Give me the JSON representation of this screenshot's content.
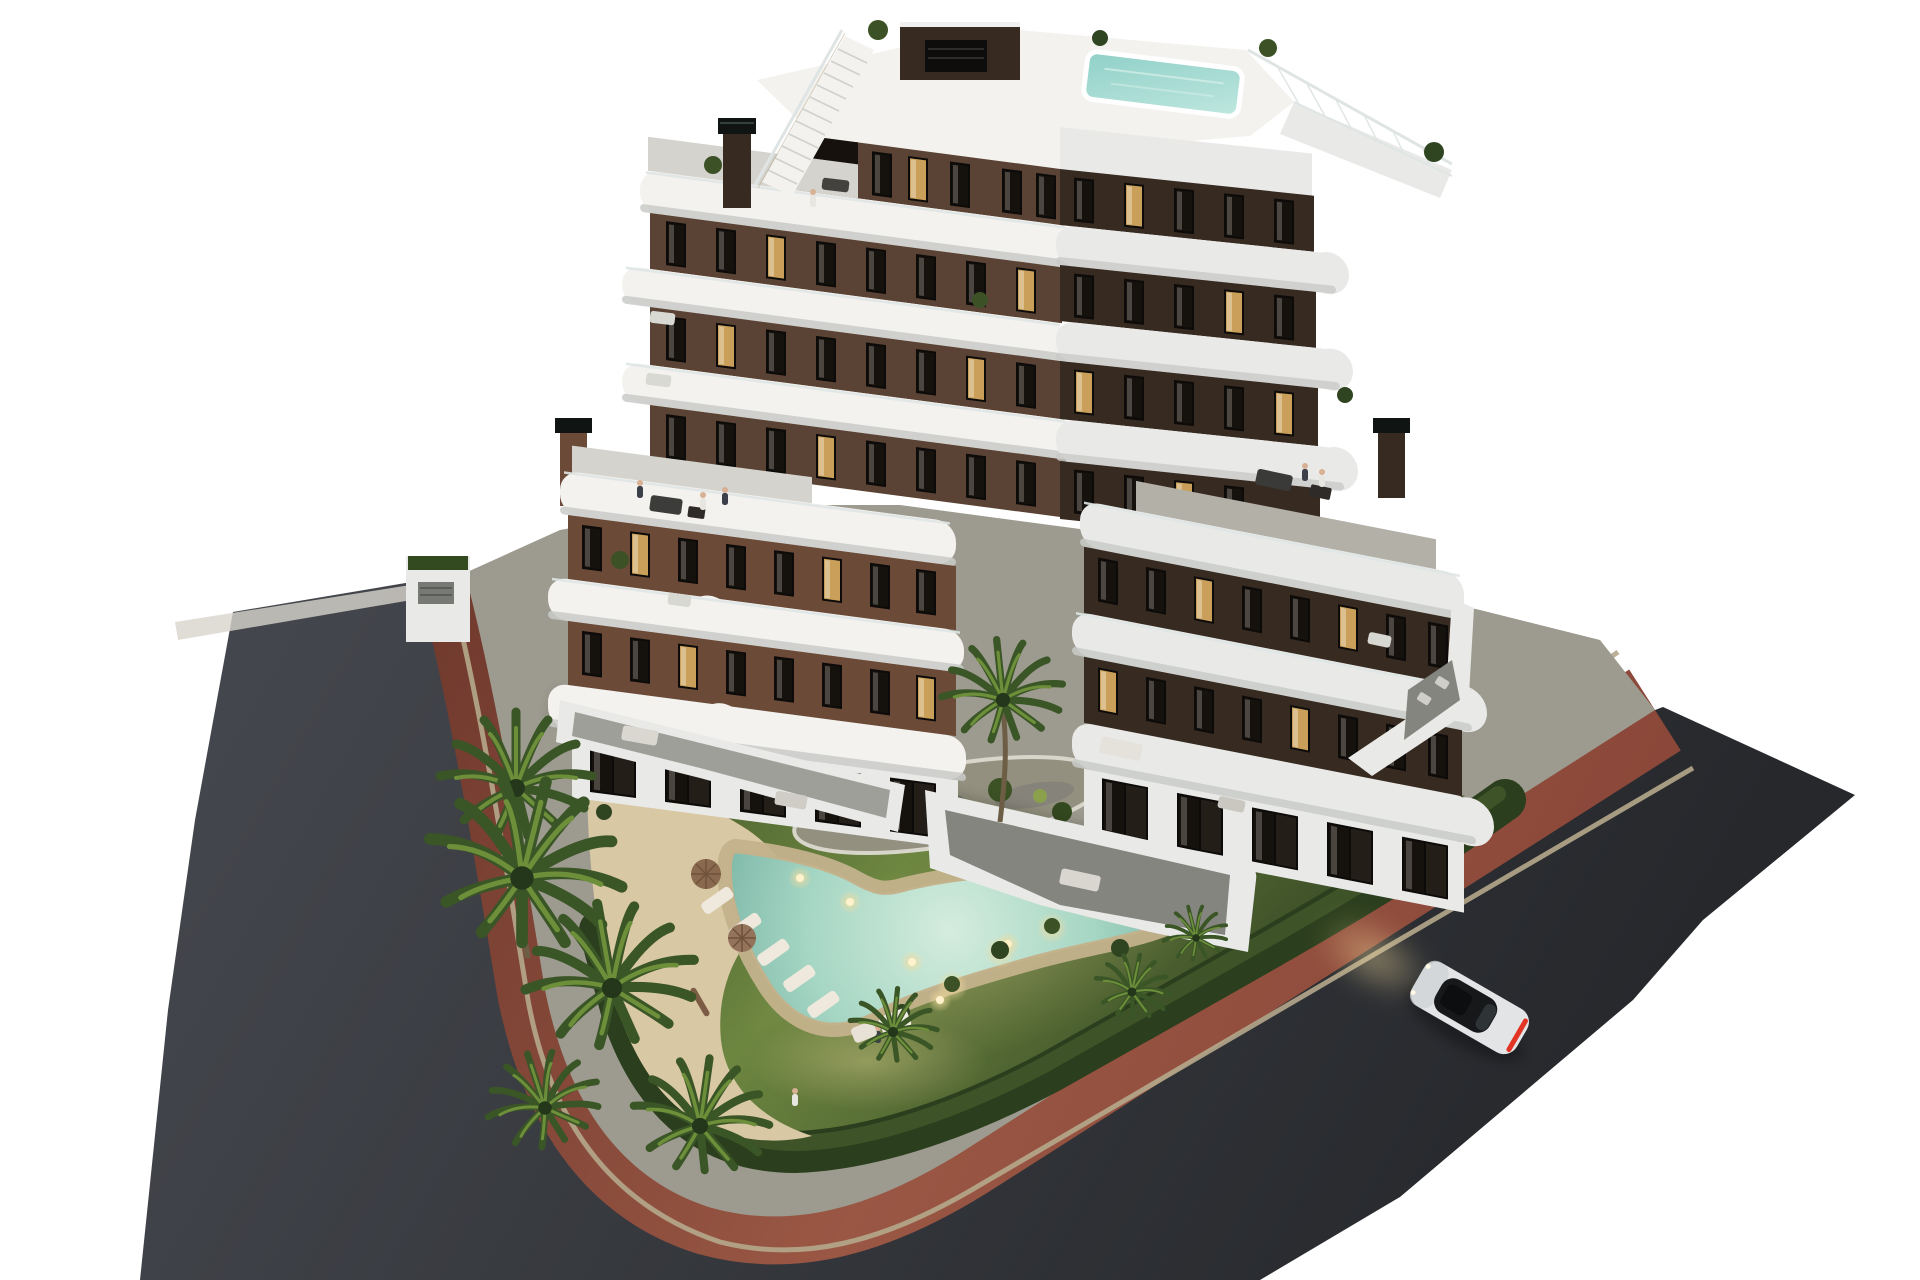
{
  "scene": {
    "domain": "natural-image",
    "description": "Dusk aerial 3D architectural rendering of a modern white-and-brown apartment building with curved balcony bands, rooftop pool, communal garden with boomerang-shaped swimming pool, palm trees, perimeter hedge, red bike path, dark asphalt streets and a single white car driving with headlights on.",
    "time_of_day": "dusk",
    "building": {
      "floors_tower": 7,
      "wings": 2,
      "features": [
        "rooftop terrace",
        "rooftop plunge pool",
        "external roof stair",
        "chimneys",
        "curved white balcony bands",
        "glass railings",
        "ground-floor walled terraces"
      ]
    },
    "garden": {
      "pool_shape": "boomerang",
      "pool_lights": 6,
      "sun_loungers": 5,
      "parasols": 3,
      "palm_trees": 9,
      "island_planter": 1
    },
    "streets": {
      "car_count": 1,
      "car_color": "white",
      "bike_path_color": "oxide red",
      "asphalt_color": "dark grey"
    },
    "people_visible": 8
  },
  "palette": {
    "bg": "#ffffff",
    "asphalt1": "#43464c",
    "asphalt2": "#26282c",
    "red1": "#6f392d",
    "red2": "#9a5744",
    "red3": "#8a4638",
    "curb_tan": "#b5a88c",
    "shoulder": "#d8d5cc",
    "concrete": "#9d9b8f",
    "lawn1": "#6d8640",
    "lawn2": "#3f5229",
    "hedge": "#2b3e1d",
    "hedge_hi": "#42582a",
    "sand1": "#d9c8a4",
    "sand2": "#c3b28c",
    "water_edge": "#76b2a2",
    "water_mid": "#a6d6c4",
    "water_light": "#d4ecdd",
    "light_warm": "#fff2cc",
    "glow_warm": "#f2dc9e",
    "brown_lit": "#5a4334",
    "brown_dark": "#372a21",
    "brick_lit": "#6b4a38",
    "white_warm": "#f3f2ee",
    "white_cool": "#e9eae8",
    "white_shade": "#c9cbc8",
    "deck_grey": "#d4d3cd",
    "terrace_grey": "#84857e",
    "window_dark": "#15110d",
    "window_lit": "#c99f5a",
    "frame_dark": "#0d0b09",
    "railing": "#dfe5e4",
    "palm_dark": "#3a5526",
    "palm_light": "#6d8f3a",
    "trunk": "#6d5d45",
    "pebble": "#93907f",
    "car_body": "#e2e4e6",
    "car_glass": "#16181a",
    "car_tail": "#e23424",
    "skin": "#d8b094",
    "pool_top": "#8fd0c8"
  }
}
